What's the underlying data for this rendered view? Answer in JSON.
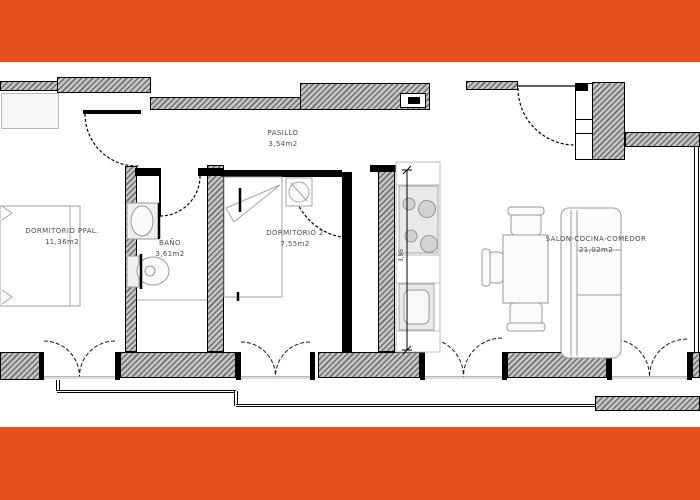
{
  "canvas": {
    "width": 700,
    "height": 500
  },
  "theme": {
    "band_color": "#E5511E",
    "wall_line_color": "#000000",
    "wall_hatch_color": "#6f6f6f",
    "furniture_line_color": "#9a9a9a",
    "label_color": "#4d4d4d"
  },
  "floorplan": {
    "rooms": [
      {
        "id": "dormitorio-ppal",
        "name": "DORMITORIO PPAL.",
        "area": "11,36m2"
      },
      {
        "id": "bano",
        "name": "BAÑO",
        "area": "3,61m2"
      },
      {
        "id": "dormitorio-2",
        "name": "DORMITORIO 2",
        "area": "7,55m2"
      },
      {
        "id": "pasillo",
        "name": "PASILLO",
        "area": "3,54m2"
      },
      {
        "id": "salon-cocina-comedor",
        "name": "SALON-COCINA-COMEDOR",
        "area": "21,02m2"
      }
    ],
    "dimensions": [
      {
        "id": "kitchen-depth",
        "value": "3,95"
      }
    ],
    "icons": [
      {
        "name": "hob-icon",
        "meaning": "4-burner cooktop"
      },
      {
        "name": "sink-icon",
        "meaning": "kitchen sink"
      },
      {
        "name": "toilet-icon",
        "meaning": "toilet"
      },
      {
        "name": "washbasin-icon",
        "meaning": "bathroom basin"
      },
      {
        "name": "bed-icon",
        "meaning": "bed"
      },
      {
        "name": "sofa-icon",
        "meaning": "sofa"
      },
      {
        "name": "dining-table-icon",
        "meaning": "table with chairs"
      },
      {
        "name": "door-swing-icon",
        "meaning": "door swing arc"
      },
      {
        "name": "window-swing-icon",
        "meaning": "french window arcs"
      },
      {
        "name": "electrical-panel-icon",
        "meaning": "panel in corridor wall"
      }
    ]
  }
}
